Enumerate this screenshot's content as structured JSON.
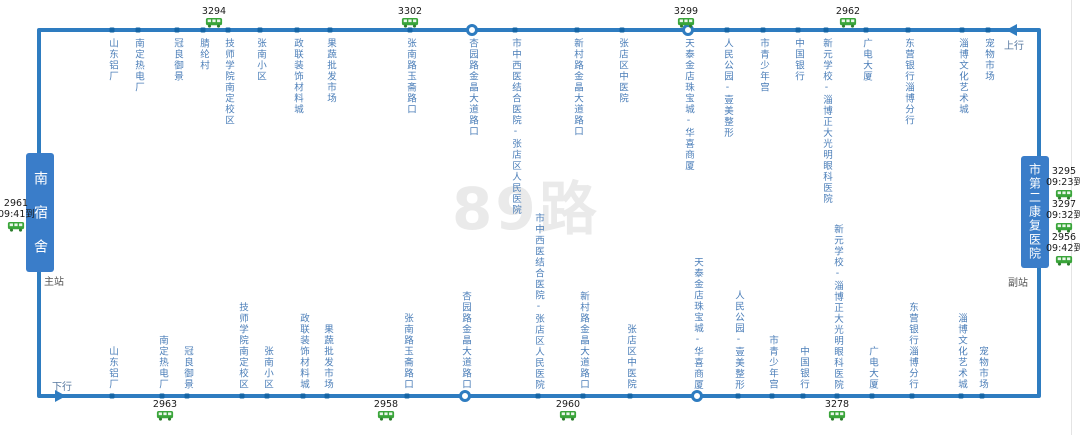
{
  "route": {
    "watermark": "89路",
    "up_label": "上行",
    "down_label": "下行",
    "main_station_label": "主站",
    "sub_station_label": "副站"
  },
  "terminals": {
    "left": {
      "name": "南宿舍"
    },
    "right": {
      "name": "市第二康复医院"
    }
  },
  "colors": {
    "line": "#2e7cc0",
    "dot": "#1565a5",
    "label": "#4b7eb8",
    "terminal_bg": "#3a7dc9",
    "bus_green": "#3aa53a",
    "text_dark": "#1a1a1a"
  },
  "top_stations": [
    {
      "name": "山东铝厂",
      "x": 112,
      "marker": "dot"
    },
    {
      "name": "南定热电厂",
      "x": 138,
      "marker": "dot"
    },
    {
      "name": "冠良御景",
      "x": 177,
      "marker": "dot"
    },
    {
      "name": "腈纶村",
      "x": 203,
      "marker": "dot"
    },
    {
      "name": "技师学院南定校区",
      "x": 228,
      "marker": "dot"
    },
    {
      "name": "张南小区",
      "x": 260,
      "marker": "dot"
    },
    {
      "name": "政联装饰材料城",
      "x": 297,
      "marker": "dot"
    },
    {
      "name": "果蔬批发市场",
      "x": 330,
      "marker": "dot"
    },
    {
      "name": "张南路玉斋路口",
      "x": 410,
      "marker": "dot"
    },
    {
      "name": "杏园路金晶大道路口",
      "x": 472,
      "marker": "circle"
    },
    {
      "name": "市中西医结合医院-张店区人民医院",
      "x": 515,
      "marker": "dot"
    },
    {
      "name": "新村路金晶大道路口",
      "x": 577,
      "marker": "dot"
    },
    {
      "name": "张店区中医院",
      "x": 622,
      "marker": "dot"
    },
    {
      "name": "天泰金店珠宝城-华喜商厦",
      "x": 688,
      "marker": "circle"
    },
    {
      "name": "人民公园-壹美整形",
      "x": 727,
      "marker": "dot"
    },
    {
      "name": "市青少年宫",
      "x": 763,
      "marker": "dot"
    },
    {
      "name": "中国银行",
      "x": 798,
      "marker": "dot"
    },
    {
      "name": "新元学校-淄博正大光明眼科医院",
      "x": 826,
      "marker": "dot"
    },
    {
      "name": "广电大厦",
      "x": 866,
      "marker": "dot"
    },
    {
      "name": "东营银行淄博分行",
      "x": 908,
      "marker": "dot"
    },
    {
      "name": "淄博文化艺术城",
      "x": 962,
      "marker": "dot"
    },
    {
      "name": "宠物市场",
      "x": 988,
      "marker": "dot"
    }
  ],
  "bottom_stations": [
    {
      "name": "山东铝厂",
      "x": 112,
      "marker": "dot"
    },
    {
      "name": "南定热电厂",
      "x": 162,
      "marker": "dot"
    },
    {
      "name": "冠良御景",
      "x": 187,
      "marker": "dot"
    },
    {
      "name": "技师学院南定校区",
      "x": 242,
      "marker": "dot"
    },
    {
      "name": "张南小区",
      "x": 267,
      "marker": "dot"
    },
    {
      "name": "政联装饰材料城",
      "x": 303,
      "marker": "dot"
    },
    {
      "name": "果蔬批发市场",
      "x": 327,
      "marker": "dot"
    },
    {
      "name": "张南路玉斋路口",
      "x": 407,
      "marker": "dot"
    },
    {
      "name": "杏园路金晶大道路口",
      "x": 465,
      "marker": "circle"
    },
    {
      "name": "市中西医结合医院-张店区人民医院",
      "x": 538,
      "marker": "dot"
    },
    {
      "name": "新村路金晶大道路口",
      "x": 583,
      "marker": "dot"
    },
    {
      "name": "张店区中医院",
      "x": 630,
      "marker": "dot"
    },
    {
      "name": "天泰金店珠宝城-华喜商厦",
      "x": 697,
      "marker": "circle"
    },
    {
      "name": "人民公园-壹美整形",
      "x": 738,
      "marker": "dot"
    },
    {
      "name": "市青少年宫",
      "x": 772,
      "marker": "dot"
    },
    {
      "name": "中国银行",
      "x": 803,
      "marker": "dot"
    },
    {
      "name": "新元学校-淄博正大光明眼科医院",
      "x": 837,
      "marker": "dot"
    },
    {
      "name": "广电大厦",
      "x": 872,
      "marker": "dot"
    },
    {
      "name": "东营银行淄博分行",
      "x": 912,
      "marker": "dot"
    },
    {
      "name": "淄博文化艺术城",
      "x": 961,
      "marker": "dot"
    },
    {
      "name": "宠物市场",
      "x": 982,
      "marker": "dot"
    }
  ],
  "top_buses": [
    {
      "id": "3294",
      "x": 214
    },
    {
      "id": "3302",
      "x": 410
    },
    {
      "id": "3299",
      "x": 686
    },
    {
      "id": "2962",
      "x": 848
    }
  ],
  "bottom_buses": [
    {
      "id": "2963",
      "x": 165
    },
    {
      "id": "2958",
      "x": 386
    },
    {
      "id": "2960",
      "x": 568
    },
    {
      "id": "3278",
      "x": 837
    }
  ],
  "left_arrivals": [
    {
      "id": "2961",
      "time": "09:41到"
    }
  ],
  "right_arrivals": [
    {
      "id": "3295",
      "time": "09:23到"
    },
    {
      "id": "3297",
      "time": "09:32到"
    },
    {
      "id": "2956",
      "time": "09:42到"
    }
  ]
}
